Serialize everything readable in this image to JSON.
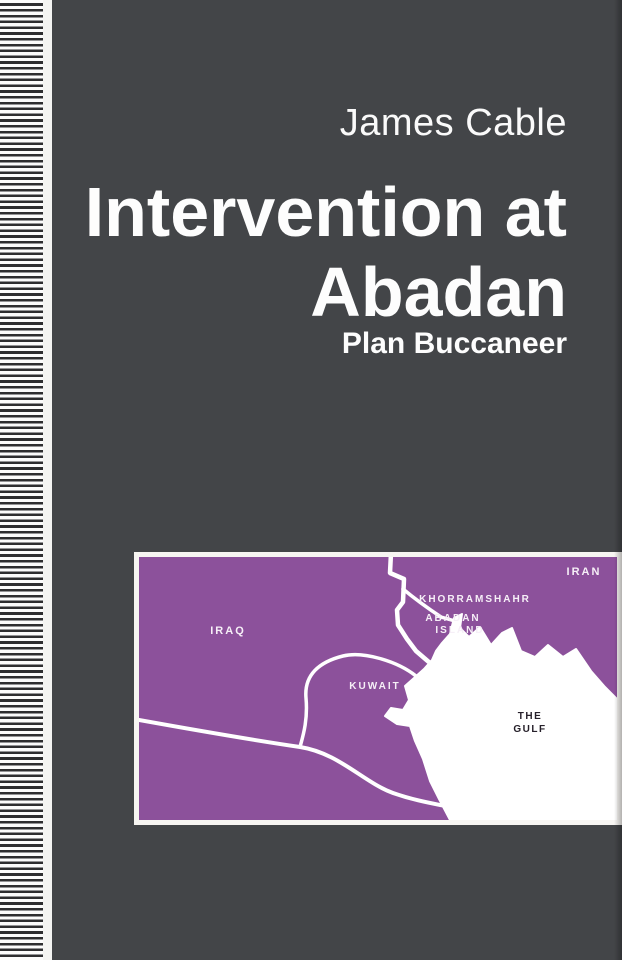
{
  "cover": {
    "author": "James Cable",
    "title_line1": "Intervention at",
    "title_line2": "Abadan",
    "subtitle": "Plan Buccaneer",
    "colors": {
      "cover_background": "#434548",
      "spine_stripe_dark": "#2e2e30",
      "spine_stripe_light": "#fbfbfb",
      "text_white": "#fdfdfd",
      "map_purple": "#8c519b",
      "map_frame_white": "#f7f5f2",
      "map_water_white": "#ffffff",
      "gulf_label_dark": "#26202a"
    }
  },
  "map": {
    "labels": {
      "iraq": "IRAQ",
      "kuwait": "KUWAIT",
      "khorramshahr": "KHORRAMSHAHR",
      "abadan_line1": "ABADAN",
      "abadan_line2": "ISLAND",
      "iran": "IRAN",
      "gulf_line1": "THE",
      "gulf_line2": "GULF"
    }
  }
}
